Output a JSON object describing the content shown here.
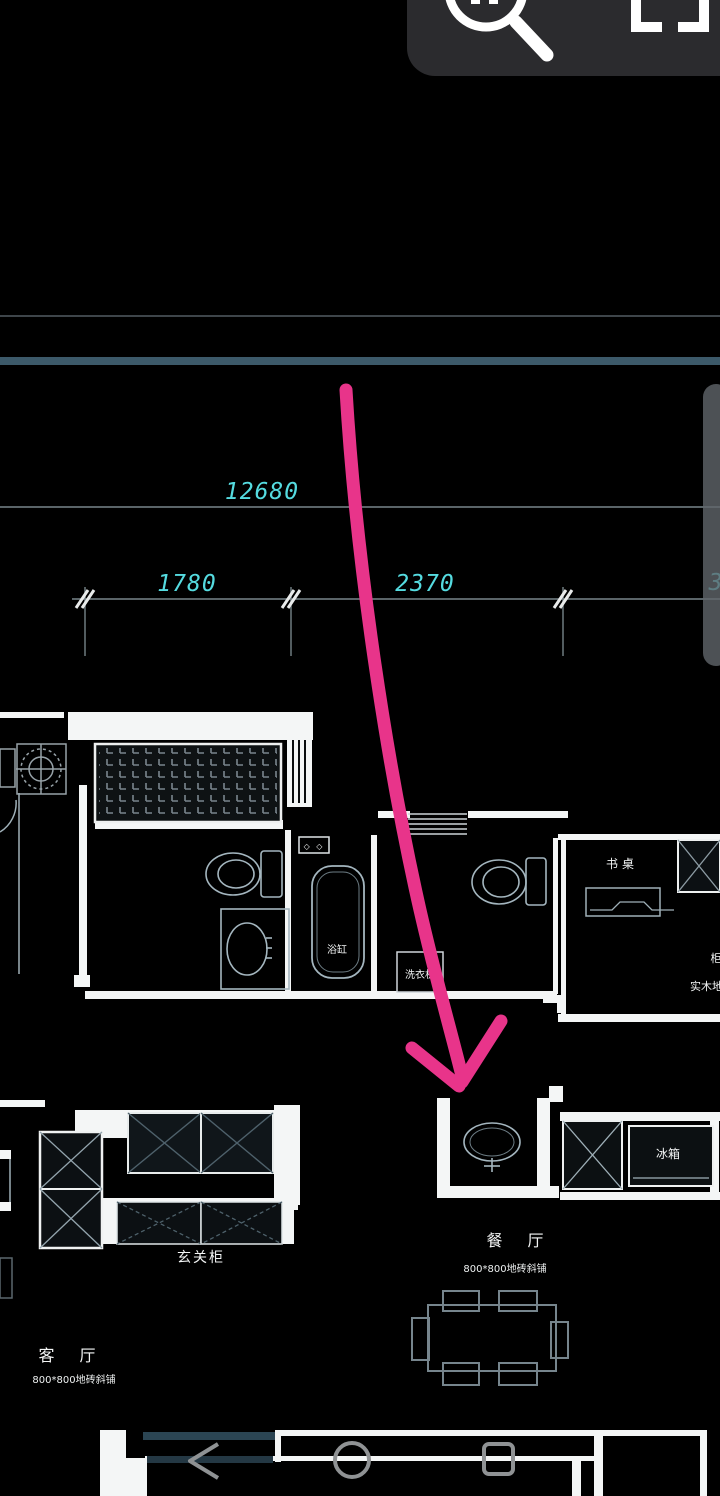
{
  "app": {
    "type": "cad-floorplan-viewer",
    "background": "#000000"
  },
  "toolbar": {
    "background": "#2b2b2e",
    "icon_color": "#ffffff",
    "icons": [
      {
        "name": "zoom-magnifier-icon"
      },
      {
        "name": "crop-frame-icon"
      }
    ]
  },
  "scrollbar": {
    "color": "rgba(96,101,106,0.8)"
  },
  "dimensions": {
    "color": "#55dbe0",
    "total": "12680",
    "seg1": "1780",
    "seg2": "2370",
    "partial_right": "3"
  },
  "plan_labels": {
    "entry_cabinet": "玄关柜",
    "living_room": "客 厅",
    "living_room_note": "800*800地砖斜铺",
    "dining_room": "餐 厅",
    "dining_room_note": "800*800地砖斜铺",
    "bathtub": "浴缸",
    "washer_box": "洗衣机",
    "desk": "书桌",
    "fridge": "冰箱",
    "wardrobe_partial": "柜",
    "floor_note_partial": "实木地板",
    "diamonds": "◇ ◇"
  },
  "annotation": {
    "arrow_color": "#e8348a",
    "arrow_meaning": "hand-drawn arrow pointing to sink vanity"
  },
  "nav": {
    "color": "#8f9294",
    "buttons": [
      {
        "name": "back-button"
      },
      {
        "name": "home-button"
      },
      {
        "name": "recents-button"
      }
    ]
  },
  "structure_colors": {
    "wall_white": "#f4f6f6",
    "wall_teal": "#3c5969",
    "fixture_stroke": "#a4b6bf"
  }
}
